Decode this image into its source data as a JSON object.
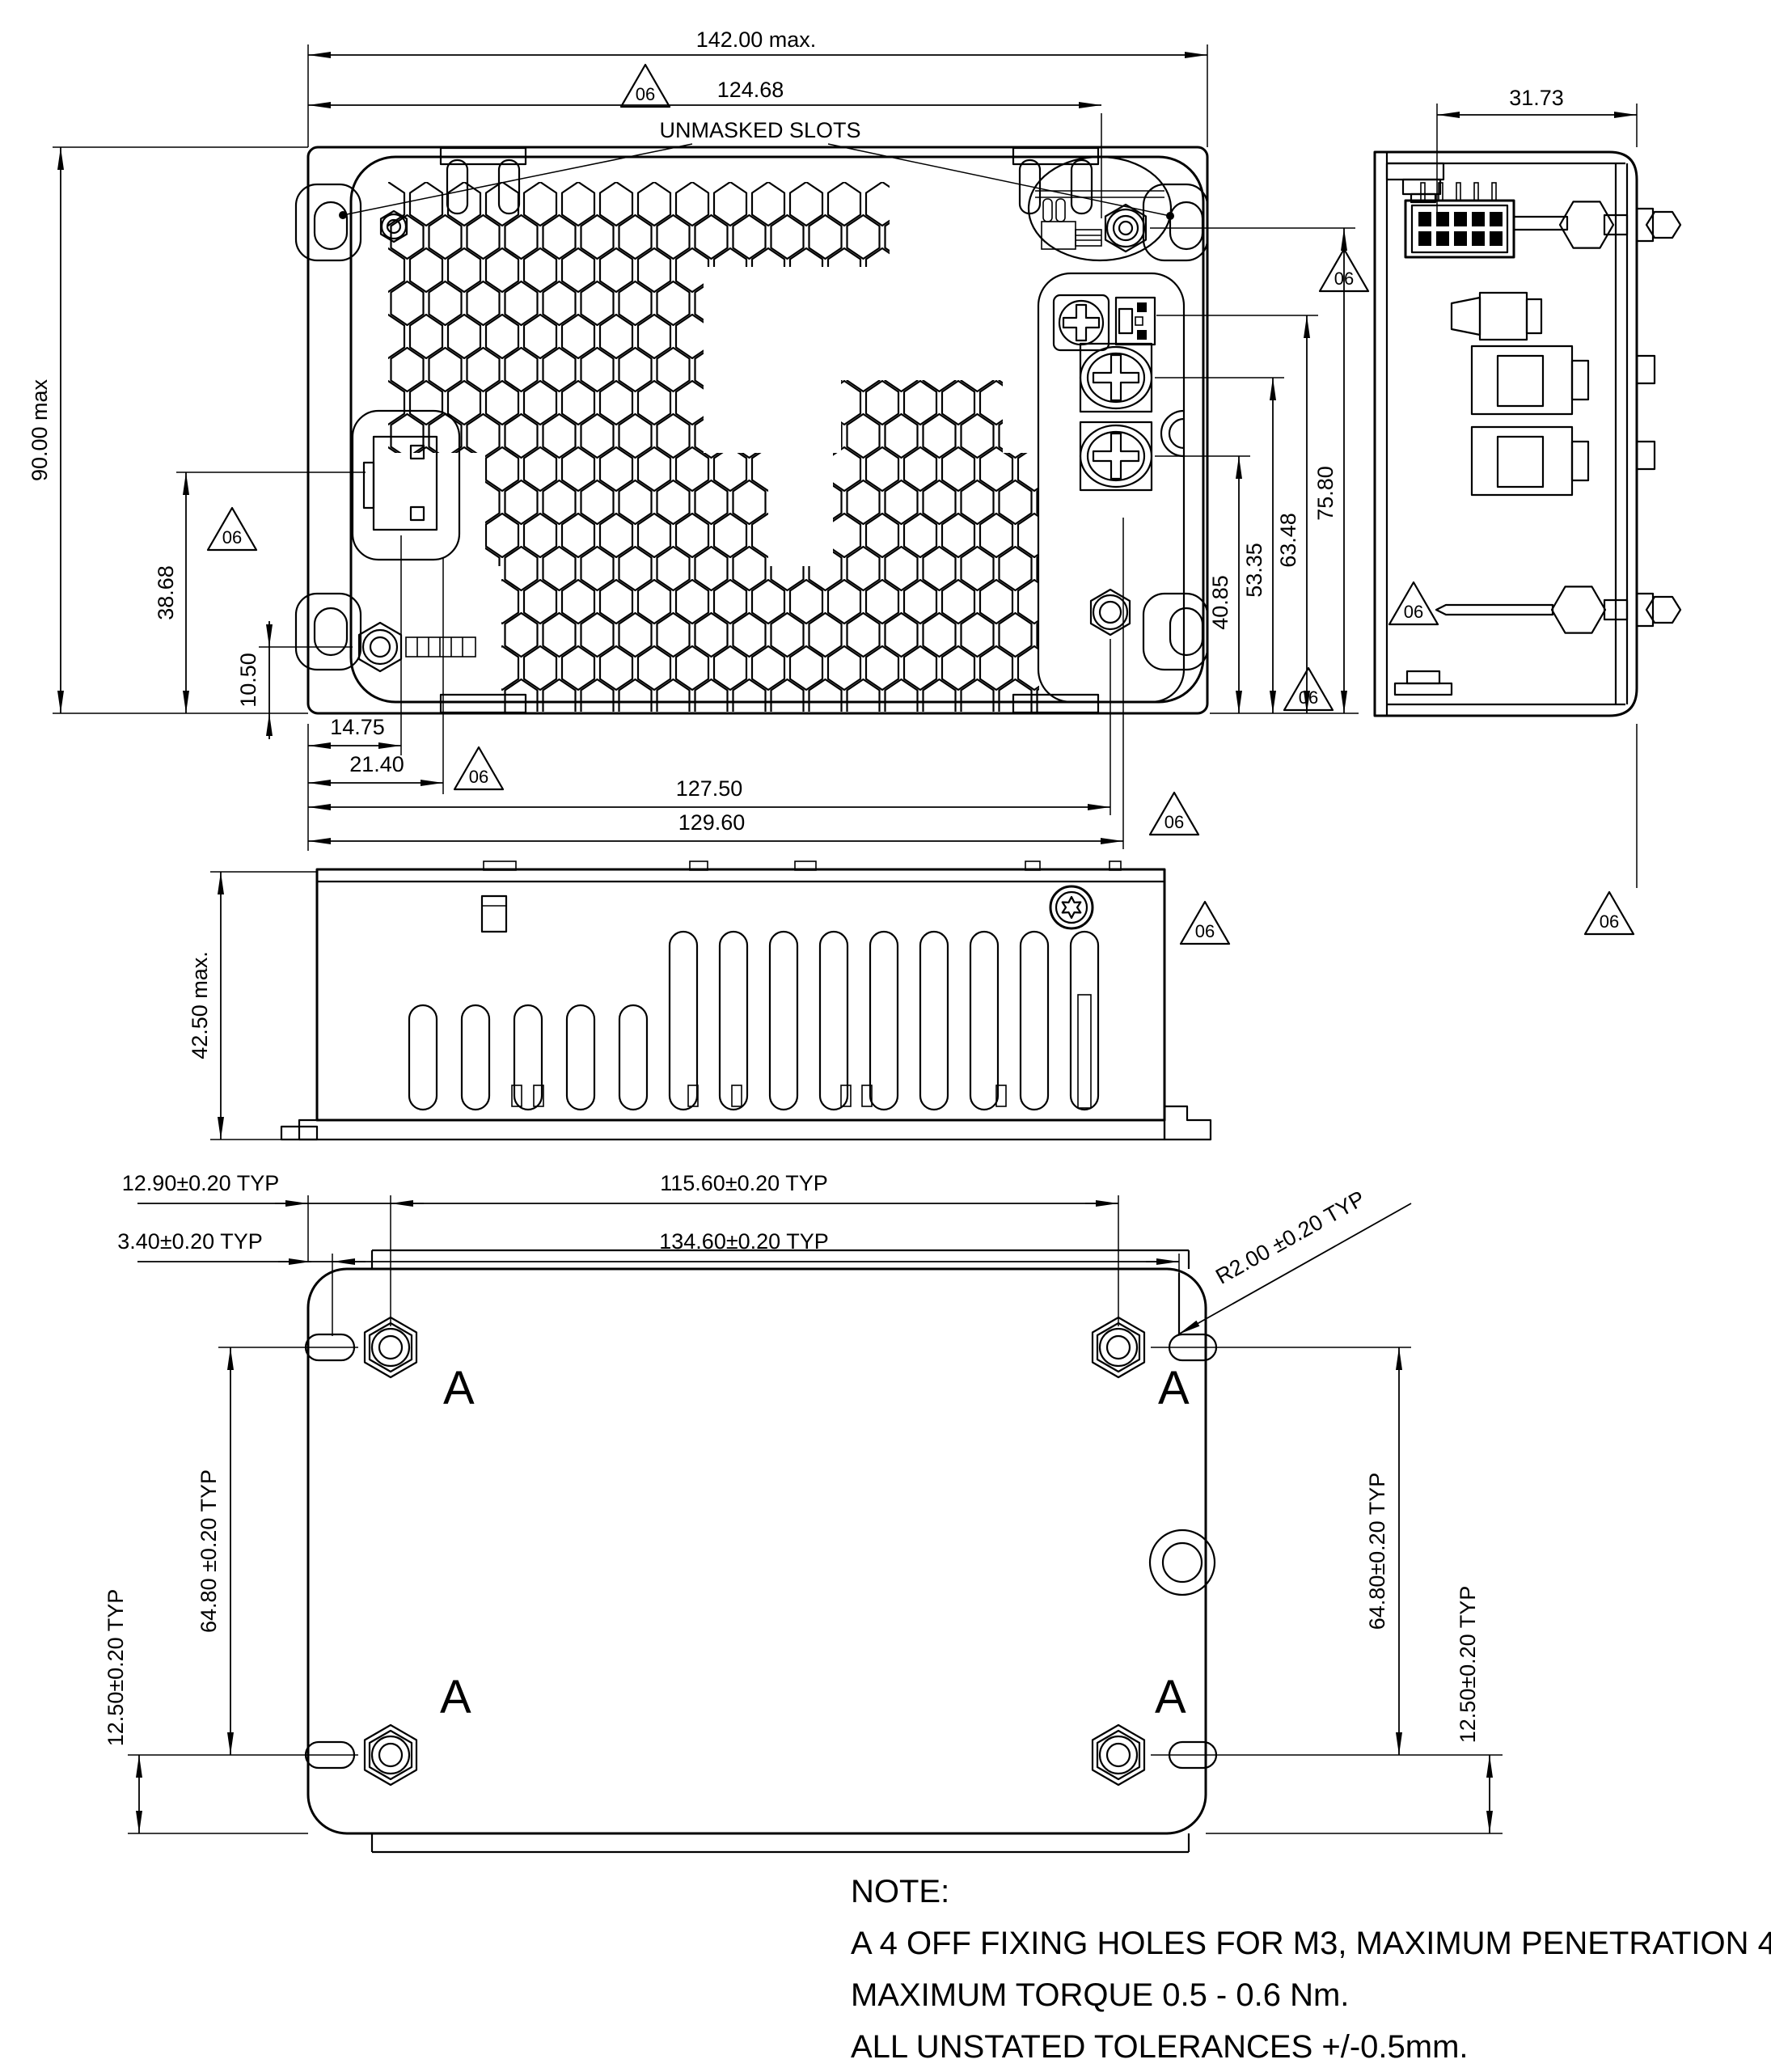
{
  "flag": "06",
  "hole_label": "A",
  "plan": {
    "width_max": "142.00 max.",
    "slot_span": "124.68",
    "unmasked_slots": "UNMASKED SLOTS",
    "depth_max": "90.00 max",
    "connector_y": "38.68",
    "nut_y": "10.50",
    "connector_x": "14.75",
    "connector_x2": "21.40",
    "screw_x": "127.50",
    "terminal_x": "129.60",
    "chain": {
      "d1": "40.85",
      "d2": "53.35",
      "d3": "63.48",
      "d4": "75.80"
    }
  },
  "side": {
    "height_max": "42.50 max."
  },
  "end": {
    "connector_offset": "31.73"
  },
  "bottom": {
    "edge_to_hole": "12.90±0.20 TYP",
    "hole_span_x": "115.60±0.20 TYP",
    "edge_to_slot": "3.40±0.20 TYP",
    "plate_width": "134.60±0.20 TYP",
    "corner_radius": "R2.00 ±0.20 TYP",
    "hole_span_y_left": "64.80 ±0.20 TYP",
    "hole_span_y_right": "64.80±0.20 TYP",
    "hole_to_edge_left": "12.50±0.20 TYP",
    "hole_to_edge_right": "12.50±0.20 TYP"
  },
  "note": {
    "title": "NOTE:",
    "line1": "A 4 OFF FIXING HOLES FOR M3, MAXIMUM PENETRATION 4.25mm,",
    "line2": "MAXIMUM TORQUE 0.5 - 0.6 Nm.",
    "line3": "ALL UNSTATED TOLERANCES +/-0.5mm."
  }
}
